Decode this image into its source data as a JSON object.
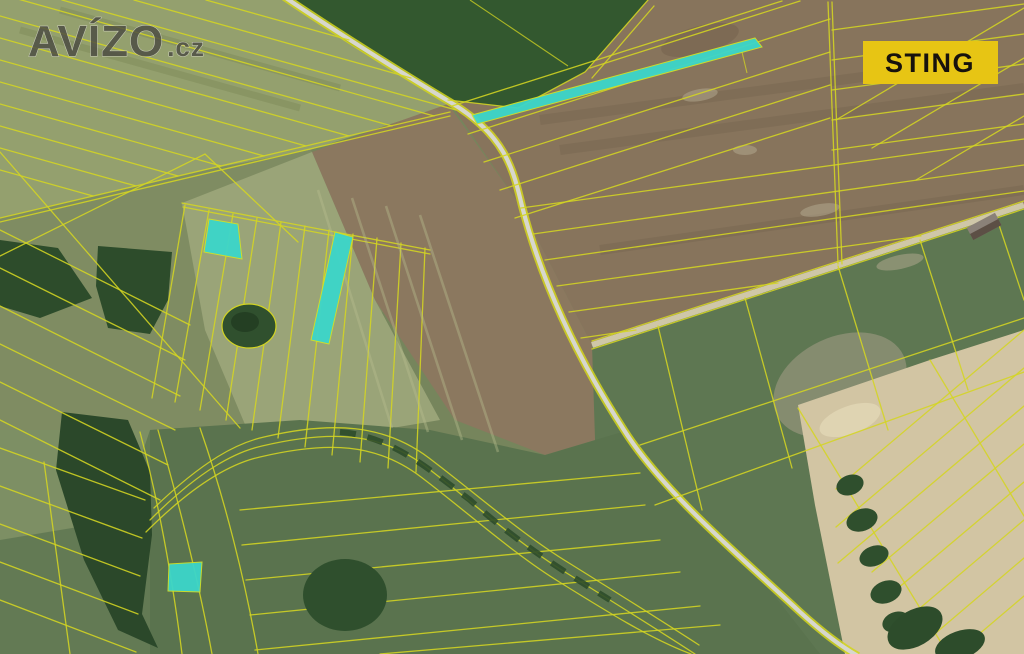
{
  "page": {
    "kind": "aerial-cadastral-map-photo",
    "width": 1024,
    "height": 654
  },
  "watermark": {
    "brand": "AVÍZO",
    "tld": ".cz",
    "color": "#4b4b43",
    "outline": "#dcdcd0"
  },
  "badge": {
    "label": "STING",
    "background": "#e7c514",
    "text_color": "#17120d"
  },
  "map": {
    "colors": {
      "parcel_line": "#d4d522",
      "highlight": "#3cd6ca",
      "highlight_outline": "#cfe02a",
      "road": "#d7d7cd",
      "plowed_field": "#87745c",
      "meadow": "#5e7752",
      "dark_crop_field": "#33582f",
      "forest": "#2d4c2b",
      "bare_soil": "#d2c5a3"
    },
    "highlighted_parcels": [
      {
        "id": "north-strip",
        "points": "472,115 755,38 762,47 477,124"
      },
      {
        "id": "west-parallelogram",
        "points": "209,219 238,224 242,259 204,252"
      },
      {
        "id": "center-strip",
        "points": "335,232 353,237 329,344 311,340"
      },
      {
        "id": "south-quad",
        "points": "169,564 202,562 200,592 168,591"
      }
    ]
  }
}
